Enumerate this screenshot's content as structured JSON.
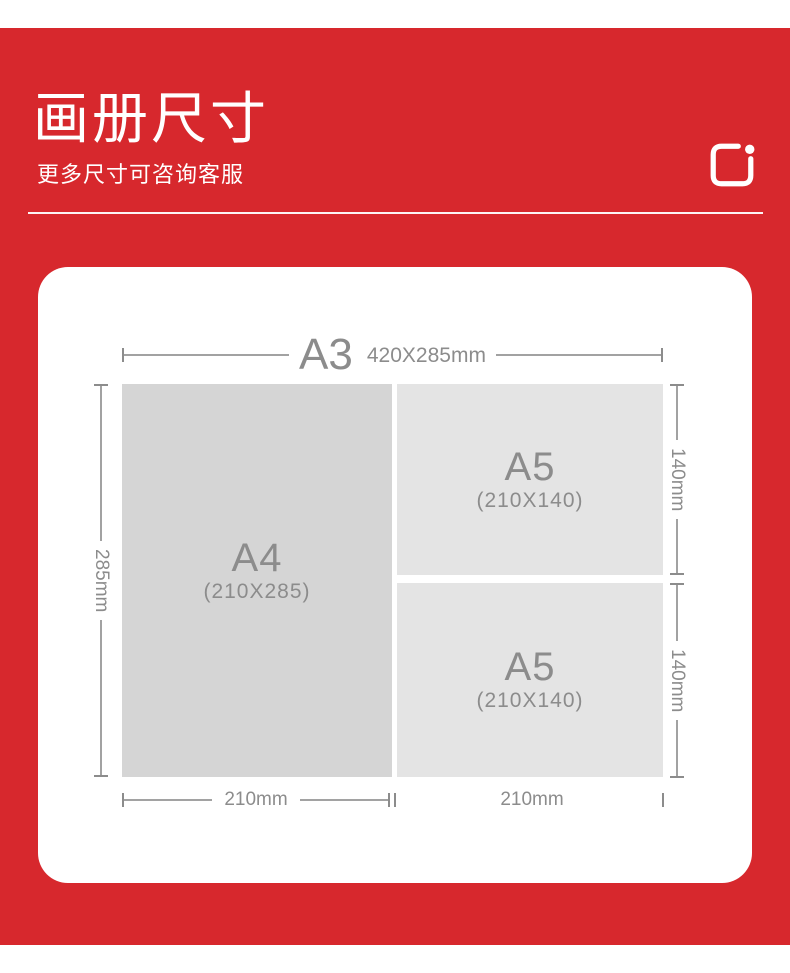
{
  "header": {
    "title": "画册尺寸",
    "subtitle": "更多尺寸可咨询客服",
    "logo_icon": "rounded-square-dot-logo"
  },
  "colors": {
    "page_red": "#d7282d",
    "card_bg": "#ffffff",
    "a4_fill": "#d5d5d5",
    "a5_fill": "#e4e4e4",
    "label_gray": "#8c8c8c",
    "line_gray": "#a2a2a2"
  },
  "diagram": {
    "outer": {
      "size_label": "A3",
      "dims_label": "420X285mm"
    },
    "sheets": [
      {
        "size_label": "A4",
        "dims_label": "(210X285)"
      },
      {
        "size_label": "A5",
        "dims_label": "(210X140)"
      },
      {
        "size_label": "A5",
        "dims_label": "(210X140)"
      }
    ],
    "left_height_label": "285mm",
    "right_height_labels": [
      "140mm",
      "140mm"
    ],
    "bottom_width_labels": [
      "210mm",
      "210mm"
    ]
  }
}
